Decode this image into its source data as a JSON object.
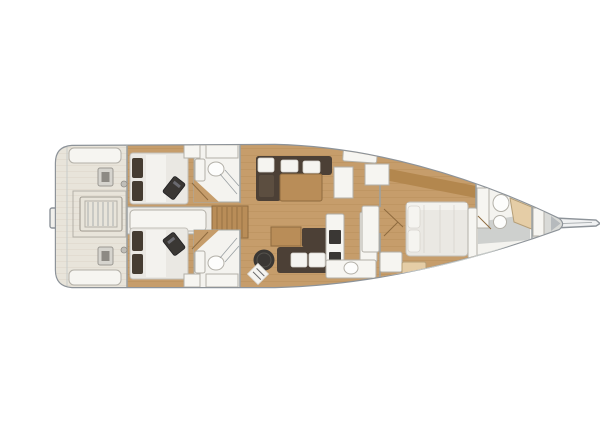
{
  "image": {
    "width": 600,
    "height": 400,
    "description": "Top-down interior floor plan of a sailing yacht: aft cockpit with twin helm pedestals and folding table, two double aft cabins each with en-suite head, companionway steps, central salon with L-shaped sofa and table, navigation stool and settee, galley counters with appliances and sink, forward owner's cabin with island bed, forward head with toilet and sink, sail locker and bowsprit at the bow"
  },
  "colors": {
    "background": "#ffffff",
    "hull_outline": "#8d9399",
    "rail": "#c8ccc9",
    "deck": "#f1f0ec",
    "cockpit_floor": "#e8e4da",
    "cockpit_line": "#d9d3c5",
    "wood_floor": "#c69d6b",
    "wood_line": "#a87f46",
    "wood_dark": "#b98d58",
    "wood_edge": "#8f6b3f",
    "headboard_wood": "#b3874e",
    "room_white": "#f4f3ef",
    "room_stroke": "#a8aca9",
    "furniture_white": "#f6f5f1",
    "furniture_stroke": "#b3b0a8",
    "sofa_dark": "#4c4036",
    "cushion_white": "#f5f4f0",
    "appliance_dark": "#3a3734",
    "pillow_dark": "#453c31",
    "mattress": "#eae8e3",
    "mattress_stroke": "#c2bfb8",
    "bathroom_gray": "#ced0ce",
    "forepeak_gray": "#d9dad7",
    "bow_tip": "#b6babd",
    "wall_line": "#9aa0a3",
    "helm": "#d6d4ce",
    "helm_dark": "#8d8a84",
    "beige_seat": "#e5cda6"
  },
  "areas": {
    "cockpit": "Cockpit with twin helms and table",
    "aft_cabin_port": "Aft double cabin (port)",
    "aft_cabin_starboard": "Aft double cabin (starboard)",
    "aft_head_port": "Aft head (port)",
    "aft_head_starboard": "Aft head (starboard)",
    "companionway": "Companionway steps",
    "salon": "Salon with L-sofa and table",
    "nav_station": "Navigation stool and settee",
    "galley": "Galley with appliances and sink",
    "owner_cabin": "Forward owner's cabin with island bed",
    "forward_head": "Forward head",
    "sail_locker": "Sail locker / forepeak",
    "bowsprit": "Bowsprit"
  }
}
